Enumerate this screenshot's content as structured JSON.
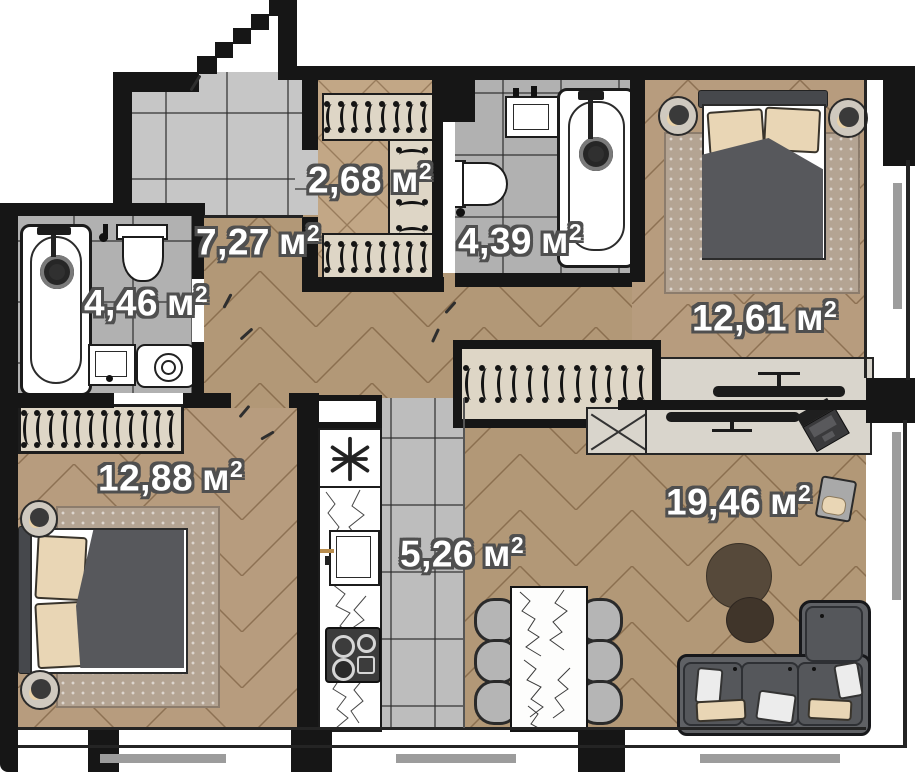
{
  "plan": {
    "title": "apartment-floor-plan",
    "unit_suffix": {
      "letter": "м",
      "sup": "2"
    },
    "rooms": [
      {
        "id": "closet",
        "label": "2,68"
      },
      {
        "id": "hallway",
        "label": "7,27"
      },
      {
        "id": "bathroom-guest",
        "label": "4,39"
      },
      {
        "id": "bathroom-master",
        "label": "4,46"
      },
      {
        "id": "bedroom-master",
        "label": "12,61"
      },
      {
        "id": "bedroom-second",
        "label": "12,88"
      },
      {
        "id": "kitchen",
        "label": "5,26"
      },
      {
        "id": "living-room",
        "label": "19,46"
      }
    ],
    "rails": {
      "hallway-rail": 12,
      "closet-top-rail": 8,
      "closet-side-rail": 6,
      "closet-bottom-rail": 8,
      "bedroom-second-rail": 12
    },
    "colors": {
      "wall": "#161616",
      "wood": "#b29877",
      "tile": "#bdbdbd",
      "rug": "#b4a493",
      "sofa": "#5f6165",
      "pillow_beige": "#e9d6b5",
      "console": "#d9d5cc",
      "label_outline": "#4f4f4f"
    }
  }
}
